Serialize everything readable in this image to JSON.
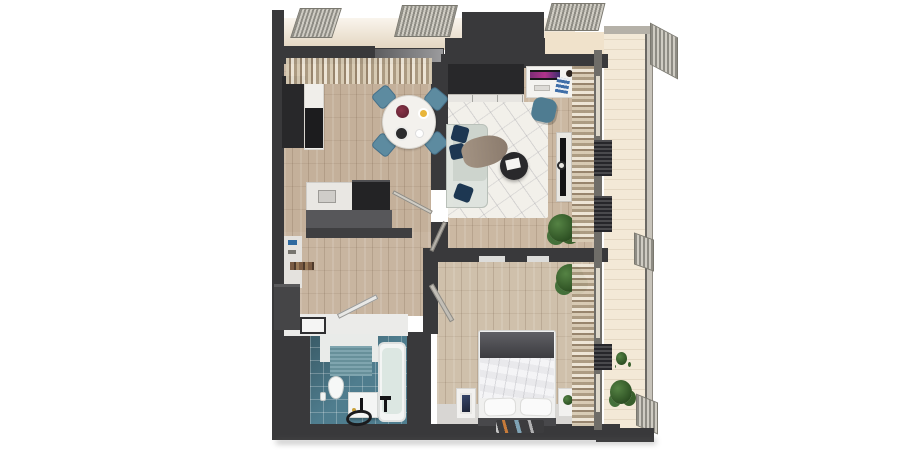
{
  "scene": {
    "type": "3d-floorplan-top-view",
    "description": "Top-down 3D render of a one-bedroom apartment with balcony",
    "background": "#ffffff"
  },
  "palette": {
    "wall": "#39393b",
    "wall_dark": "#28282a",
    "wood_kitchen": "#c4b09a",
    "wood_living": "#cbb8a2",
    "wood_hall": "#c8b5a0",
    "wood_bedroom": "#cfc0ab",
    "tile_bathroom": "#4f7d8e",
    "rug_living": "#f2f0ea",
    "sofa": "#cdd4cd",
    "pillow_navy": "#1d3752",
    "chair_teal": "#5d8ba0",
    "desk_chair_teal": "#4f7c91",
    "balcony_floor": "#f3e9d7",
    "bed_duvet": "#e9e9ec",
    "bed_blanket": "#46464b",
    "counter_white": "#ebebe9",
    "bath_mat": "#6d99a4",
    "sill_cream": "#f0e2cb",
    "bedroom_floor_strip": "#d8d6d3"
  },
  "rooms": [
    {
      "id": "kitchen-dining",
      "label": "Kitchen and dining area"
    },
    {
      "id": "living-room",
      "label": "Living room"
    },
    {
      "id": "hallway",
      "label": "Hallway"
    },
    {
      "id": "bathroom",
      "label": "Bathroom"
    },
    {
      "id": "bedroom",
      "label": "Bedroom"
    },
    {
      "id": "balcony",
      "label": "Balcony"
    }
  ],
  "furniture": {
    "kitchen": [
      "tall cabinet",
      "marble counter",
      "cooktop",
      "sink counter",
      "oven block",
      "round dining table",
      "4 teal chairs",
      "flowers",
      "plates"
    ],
    "living": [
      "wardrobe",
      "closet front",
      "desk",
      "monitor",
      "books",
      "desk chair",
      "sofa",
      "navy pillows",
      "throw blanket",
      "round coffee table",
      "geometric rug",
      "tv stand",
      "tv",
      "plant"
    ],
    "hallway": [
      "wall shelf",
      "bench",
      "laundry hatch counter"
    ],
    "bathroom": [
      "toilet",
      "vanity with faucet",
      "round floor mat",
      "bathtub",
      "floor faucet",
      "teal wall mat"
    ],
    "bedroom": [
      "double bed",
      "dark blanket",
      "two pillows",
      "left nightstand with art",
      "right nightstand with plant",
      "foot rug",
      "corner plant",
      "curtains"
    ],
    "balcony": [
      "plants",
      "railing",
      "ac units",
      "exterior mesh grilles",
      "awnings"
    ]
  }
}
